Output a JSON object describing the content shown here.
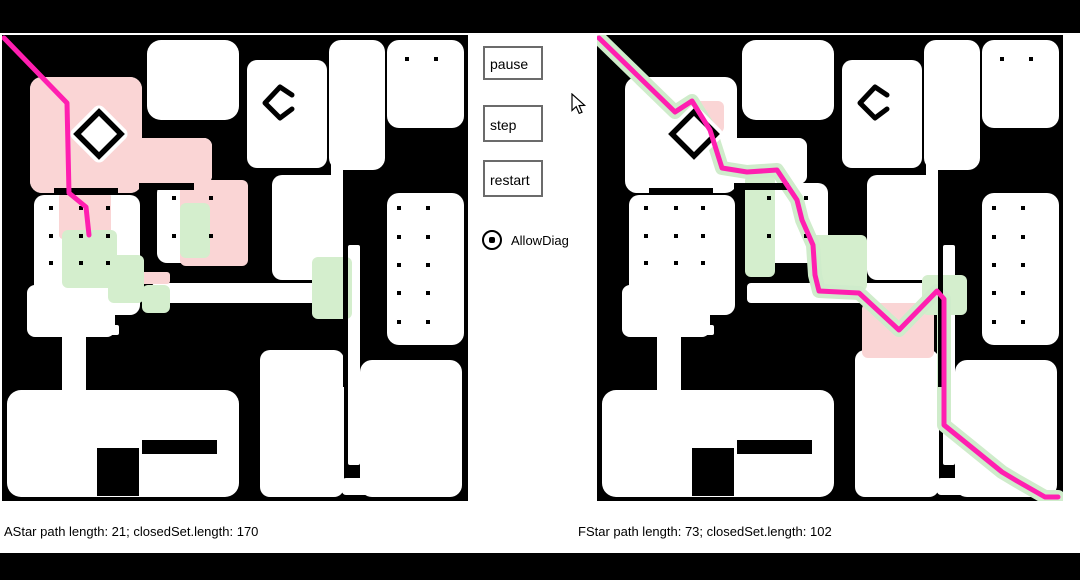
{
  "controls": {
    "pause": "pause",
    "step": "step",
    "restart": "restart",
    "allow_diag_label": "AllowDiag",
    "allow_diag_checked": true
  },
  "status": {
    "left": "AStar path length: 21; closedSet.length: 170",
    "right": "FStar path length: 73; closedSet.length: 102"
  },
  "colors": {
    "wall": "#000000",
    "room": "#ffffff",
    "path": "#ff1fb0",
    "closed_pink": "#fad5d5",
    "closed_green": "#d4eecd",
    "casing": "#cfeccb"
  },
  "map": {
    "size": 466,
    "rooms": [
      [
        28,
        42,
        112,
        116,
        12
      ],
      [
        28,
        103,
        182,
        46,
        8
      ],
      [
        145,
        5,
        92,
        80,
        14
      ],
      [
        245,
        25,
        80,
        108,
        10
      ],
      [
        327,
        5,
        56,
        130,
        12
      ],
      [
        385,
        5,
        77,
        88,
        12
      ],
      [
        385,
        158,
        77,
        152,
        12
      ],
      [
        32,
        160,
        106,
        120,
        10
      ],
      [
        25,
        250,
        88,
        52,
        8
      ],
      [
        155,
        148,
        76,
        80,
        10
      ],
      [
        270,
        140,
        70,
        105,
        10
      ],
      [
        150,
        248,
        198,
        20,
        4
      ],
      [
        329,
        110,
        12,
        150,
        2
      ],
      [
        346,
        210,
        12,
        220,
        2
      ],
      [
        60,
        295,
        24,
        65,
        4
      ],
      [
        95,
        290,
        22,
        10,
        2
      ],
      [
        5,
        355,
        232,
        107,
        14
      ],
      [
        258,
        315,
        84,
        147,
        10
      ],
      [
        358,
        325,
        102,
        137,
        12
      ],
      [
        340,
        443,
        60,
        17,
        4
      ]
    ],
    "walls": [
      [
        52,
        153,
        64,
        7
      ],
      [
        137,
        148,
        55,
        7
      ],
      [
        341,
        210,
        5,
        142
      ],
      [
        95,
        413,
        42,
        48
      ],
      [
        140,
        405,
        75,
        14
      ]
    ],
    "dots": [
      [
        405,
        24
      ],
      [
        434,
        24
      ],
      [
        397,
        173
      ],
      [
        426,
        173
      ],
      [
        397,
        202
      ],
      [
        426,
        202
      ],
      [
        397,
        230
      ],
      [
        426,
        230
      ],
      [
        397,
        258
      ],
      [
        426,
        258
      ],
      [
        397,
        287
      ],
      [
        426,
        287
      ],
      [
        49,
        173
      ],
      [
        79,
        173
      ],
      [
        106,
        173
      ],
      [
        49,
        201
      ],
      [
        79,
        201
      ],
      [
        106,
        201
      ],
      [
        49,
        228
      ],
      [
        79,
        228
      ],
      [
        106,
        228
      ],
      [
        172,
        163
      ],
      [
        209,
        163
      ],
      [
        172,
        201
      ],
      [
        209,
        201
      ]
    ],
    "diamond": {
      "cx": 97,
      "cy": 99,
      "r": 22
    },
    "open_diamond": [
      [
        290,
        60
      ],
      [
        278,
        52
      ],
      [
        263,
        68
      ],
      [
        278,
        83
      ],
      [
        290,
        74
      ]
    ]
  },
  "panels": [
    {
      "name": "astar",
      "casing": false,
      "pink": [
        [
          28,
          42,
          112,
          116,
          12
        ],
        [
          28,
          103,
          182,
          46,
          8
        ],
        [
          178,
          145,
          68,
          86,
          6
        ],
        [
          57,
          158,
          52,
          46,
          4
        ],
        [
          138,
          237,
          30,
          12,
          3
        ]
      ],
      "green": [
        [
          60,
          195,
          55,
          58,
          6
        ],
        [
          106,
          220,
          36,
          48,
          6
        ],
        [
          178,
          168,
          30,
          55,
          6
        ],
        [
          310,
          222,
          40,
          62,
          6
        ],
        [
          140,
          250,
          28,
          28,
          6
        ]
      ],
      "path": [
        [
          2,
          3
        ],
        [
          65,
          68
        ],
        [
          67,
          158
        ],
        [
          84,
          172
        ],
        [
          87,
          200
        ]
      ]
    },
    {
      "name": "fstar",
      "casing": true,
      "pink": [
        [
          265,
          268,
          72,
          55,
          6
        ],
        [
          85,
          66,
          42,
          32,
          6
        ]
      ],
      "green": [
        [
          148,
          140,
          30,
          102,
          6
        ],
        [
          214,
          200,
          56,
          56,
          6
        ],
        [
          325,
          240,
          45,
          40,
          6
        ]
      ],
      "path": [
        [
          2,
          3
        ],
        [
          78,
          77
        ],
        [
          95,
          66
        ],
        [
          113,
          95
        ],
        [
          125,
          133
        ],
        [
          150,
          137
        ],
        [
          180,
          135
        ],
        [
          200,
          165
        ],
        [
          205,
          185
        ],
        [
          216,
          210
        ],
        [
          218,
          240
        ],
        [
          222,
          256
        ],
        [
          262,
          258
        ],
        [
          302,
          295
        ],
        [
          340,
          256
        ],
        [
          347,
          264
        ],
        [
          347,
          390
        ],
        [
          405,
          437
        ],
        [
          420,
          446
        ],
        [
          448,
          462
        ],
        [
          461,
          462
        ]
      ]
    }
  ]
}
